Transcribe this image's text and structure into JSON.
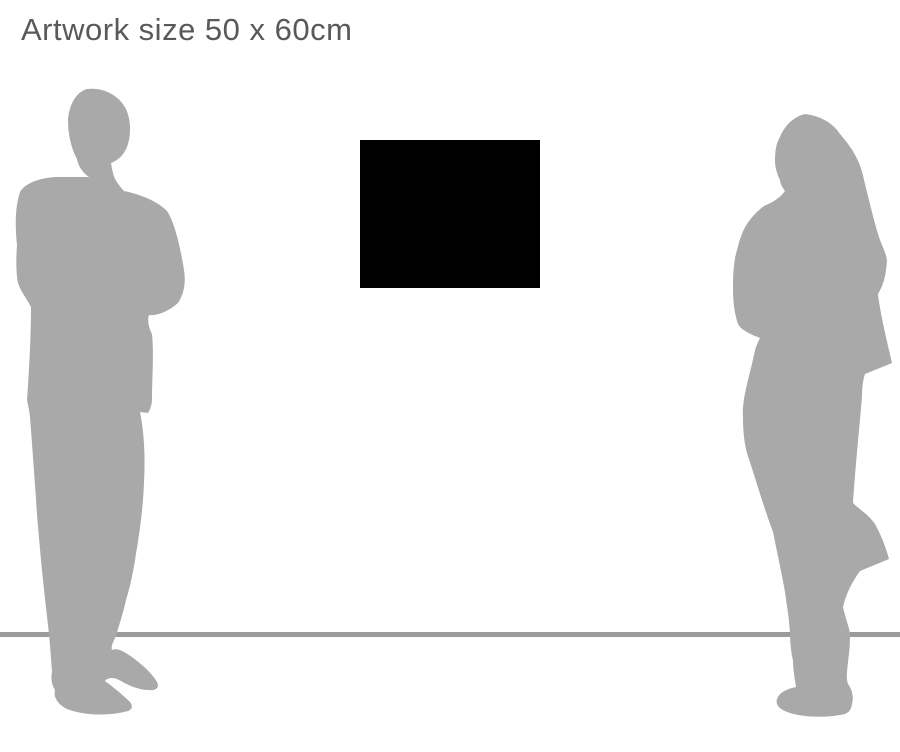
{
  "header": {
    "title": "Artwork size 50 x 60cm"
  },
  "scene": {
    "artwork": {
      "name": "artwork-rectangle"
    },
    "floor_line": {
      "name": "floor-line"
    },
    "figures": [
      {
        "name": "man-silhouette"
      },
      {
        "name": "woman-silhouette"
      }
    ]
  },
  "colors": {
    "background": "#ffffff",
    "title_text": "#58595b",
    "artwork_fill": "#000000",
    "silhouette_fill": "#a9a9a9",
    "floor_line": "#9b9b9b"
  }
}
